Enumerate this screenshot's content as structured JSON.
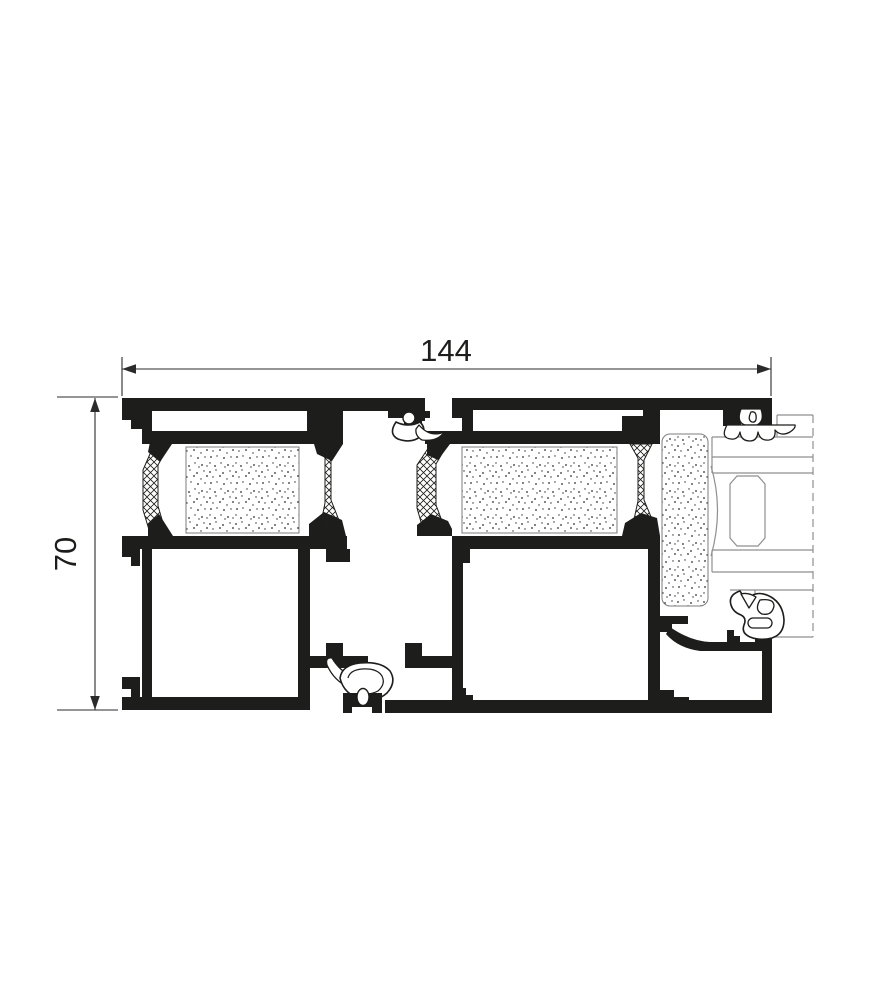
{
  "drawing": {
    "type": "aluminium-profile-cross-section",
    "dimensions": {
      "width": {
        "value": "144"
      },
      "height": {
        "value": "70"
      }
    },
    "colors": {
      "profile_fill": "#1d1d1b",
      "dimension_lines": "#2b2b2b",
      "phantom_lines": "#8f8f8f",
      "foam_border": "#7d7d7d",
      "background": "#ffffff"
    },
    "materials": {
      "solid_black": "aluminium-profile",
      "crosshatch": "thermal-break-insulator",
      "stipple": "insulation-foam",
      "thin_gray": "adjacent-sash-phantom"
    }
  }
}
